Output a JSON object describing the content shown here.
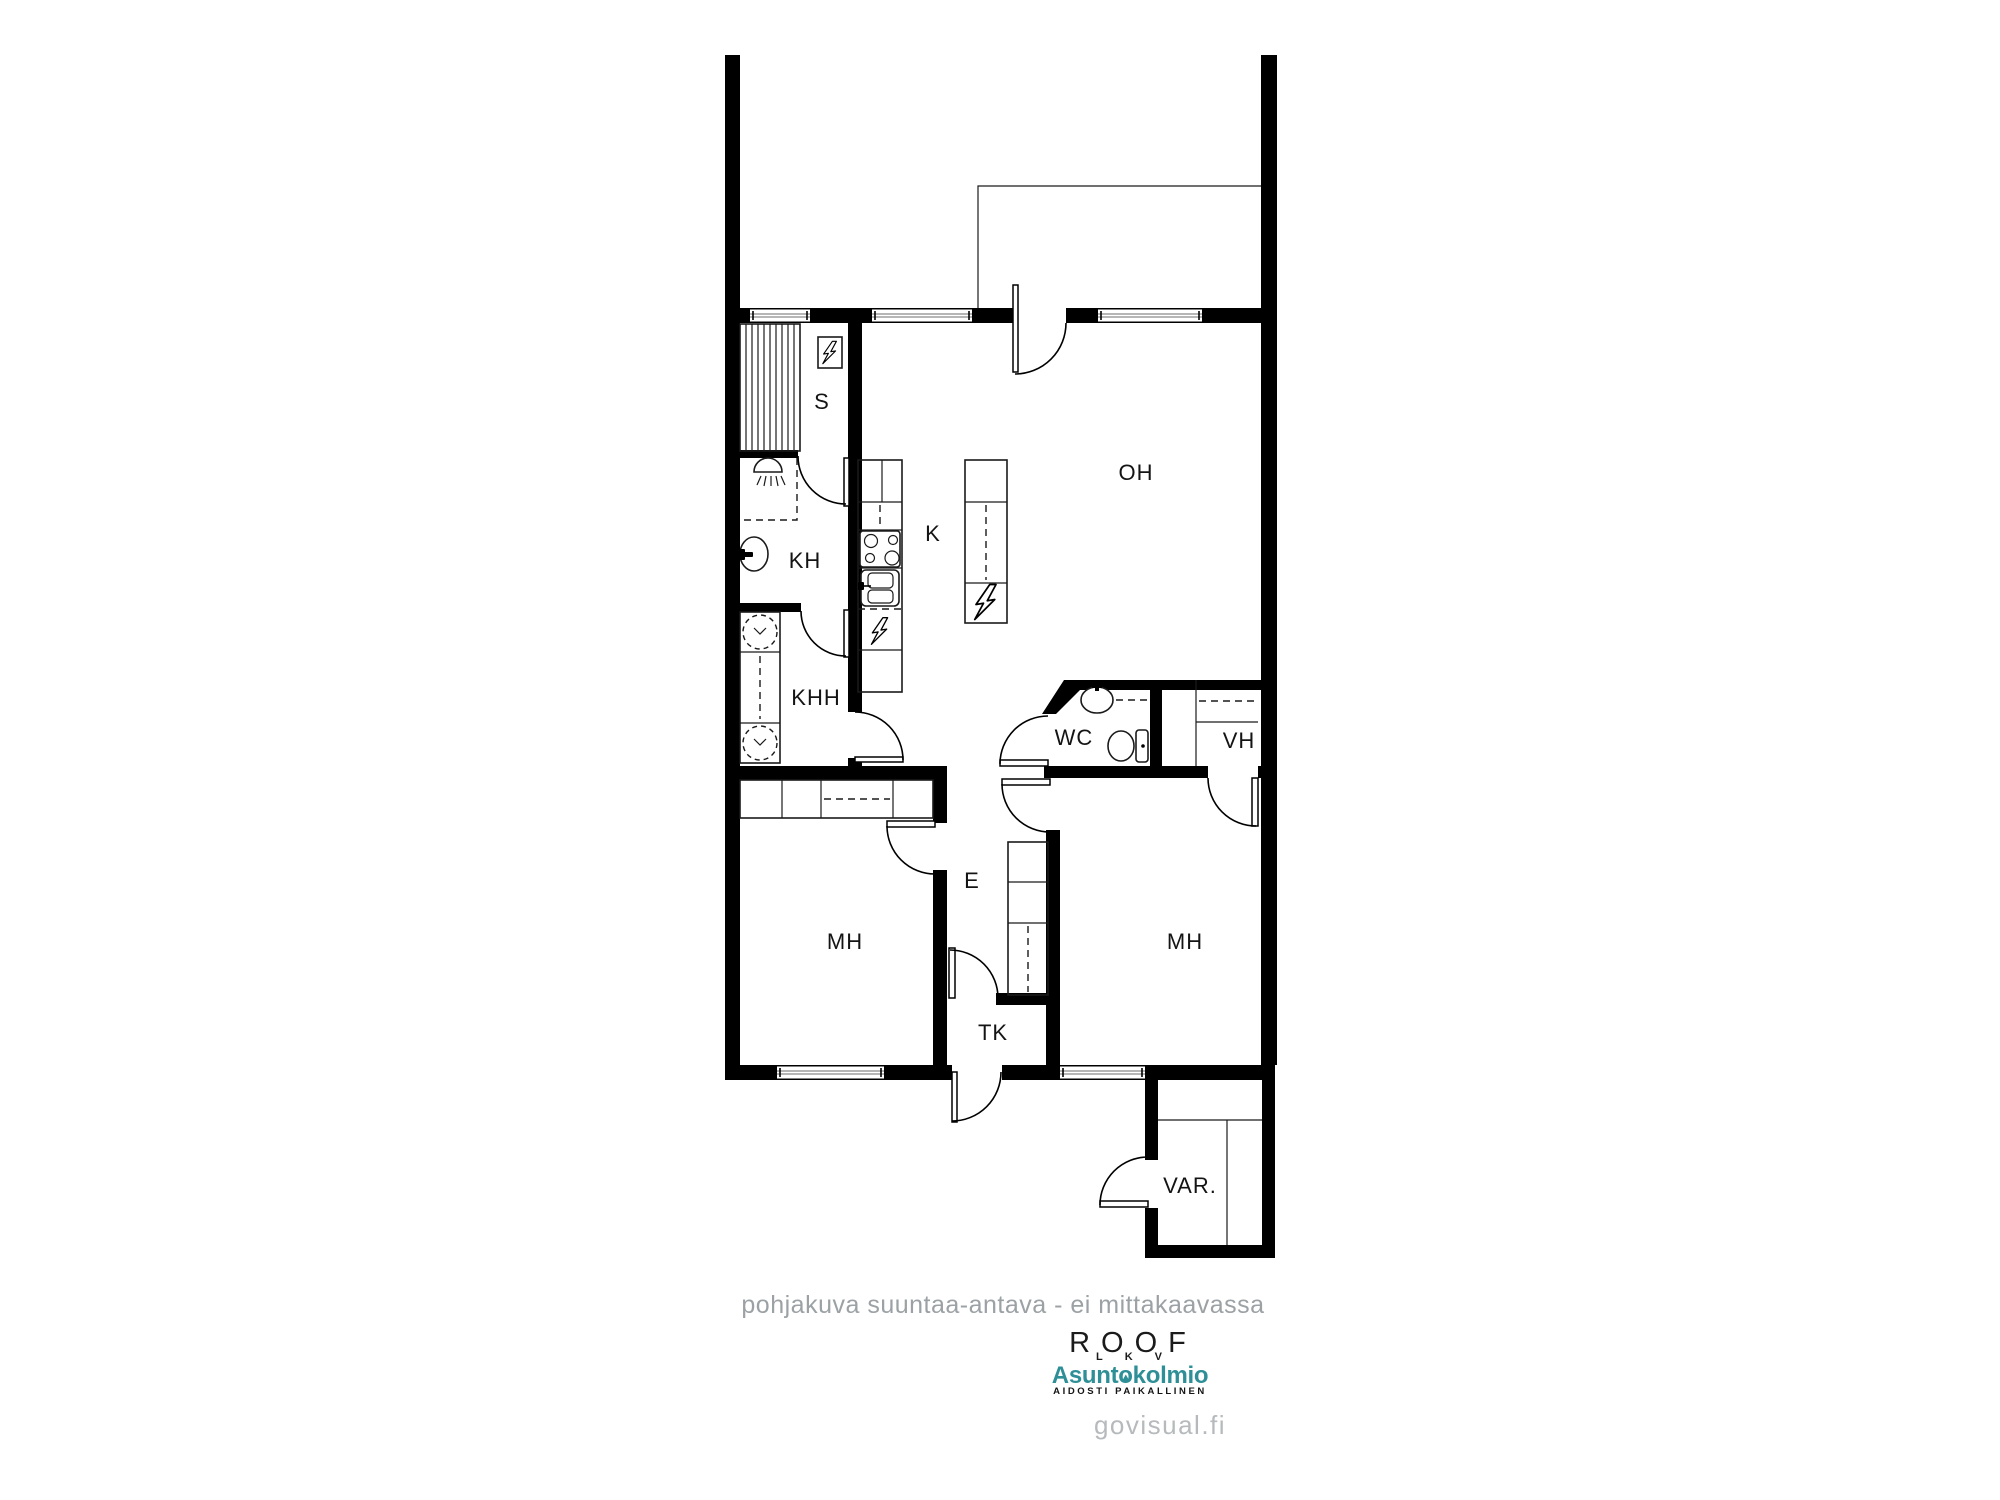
{
  "plan": {
    "rooms": {
      "sauna": "S",
      "bathroom": "KH",
      "utility": "KHH",
      "kitchen": "K",
      "living": "OH",
      "wc": "WC",
      "walk_in_closet": "VH",
      "bedroom_left": "MH",
      "hall": "E",
      "bedroom_right": "MH",
      "vestibule": "TK",
      "storage": "VAR."
    }
  },
  "footer": {
    "disclaimer": "pohjakuva suuntaa-antava - ei mittakaavassa",
    "roof_logo": "ROOF",
    "roof_sub": "LKV",
    "brand_part1": "Asunt",
    "brand_part2": "o",
    "brand_part3": "kolmio",
    "brand_tagline": "AIDOSTI PAIKALLINEN",
    "watermark": "govisual.fi"
  },
  "colors": {
    "walls": "#000000",
    "brand_teal": "#2E8F96",
    "disclaimer_gray": "#9BA1A4",
    "watermark_gray": "#B6BABD"
  }
}
